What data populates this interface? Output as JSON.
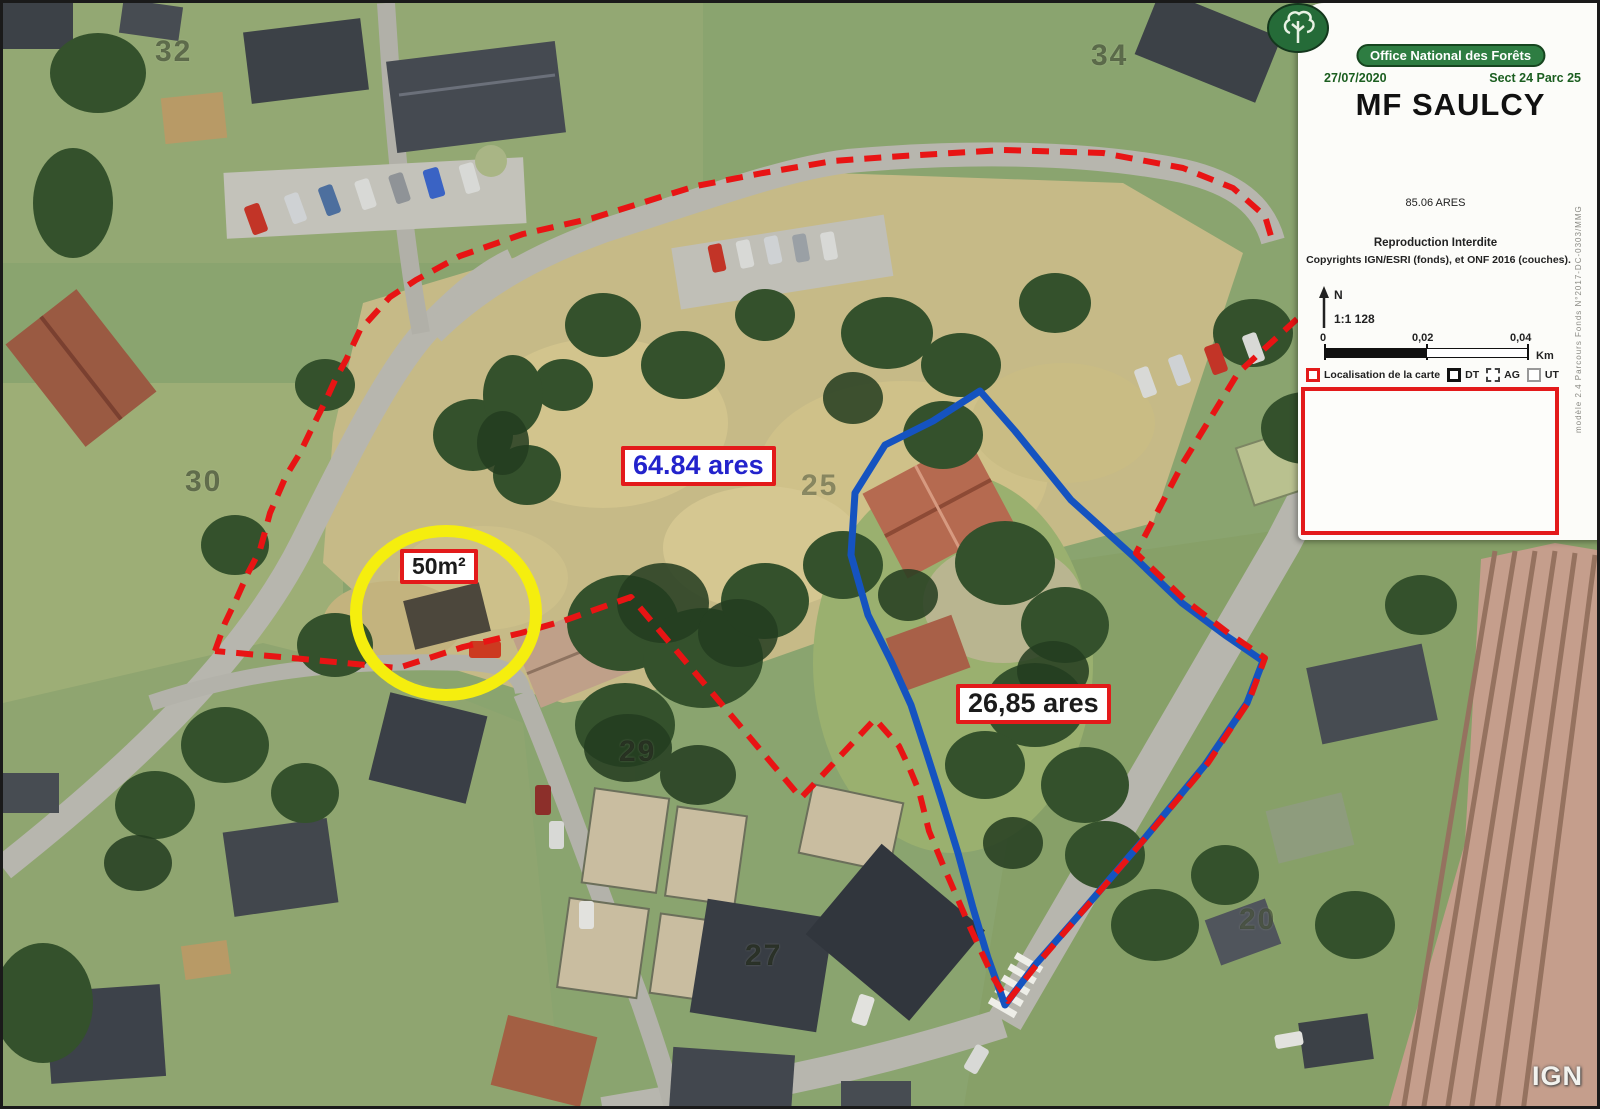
{
  "panel": {
    "org": "Office National des Forêts",
    "date": "27/07/2020",
    "sect_parc": "Sect 24 Parc 25",
    "title": "MF SAULCY",
    "area_total": "85.06 ARES",
    "notice_line1": "Reproduction Interdite",
    "notice_line2": "Copyrights IGN/ESRI (fonds), et ONF 2016 (couches).",
    "north_label": "N",
    "scale_ratio": "1:1 128",
    "scale_ticks": [
      "0",
      "0,02",
      "0,04"
    ],
    "scale_unit": "Km",
    "legend": [
      {
        "label": "Localisation de la carte"
      },
      {
        "label": "DT"
      },
      {
        "label": "AG"
      },
      {
        "label": "UT"
      }
    ],
    "side_note": "modèle 2.4 Parcours Fonds N°2017-DC-0303/MMG"
  },
  "map": {
    "labels": {
      "area_main": "64.84 ares",
      "area_secondary": "26,85 ares",
      "building_area": "50m²"
    },
    "parcels": [
      "32",
      "34",
      "30",
      "25",
      "29",
      "27",
      "20"
    ],
    "watermark": "IGN",
    "colors": {
      "boundary_red": "#e31a1a",
      "boundary_blue": "#1553c0",
      "highlight_yellow": "#f5ee0e"
    }
  }
}
